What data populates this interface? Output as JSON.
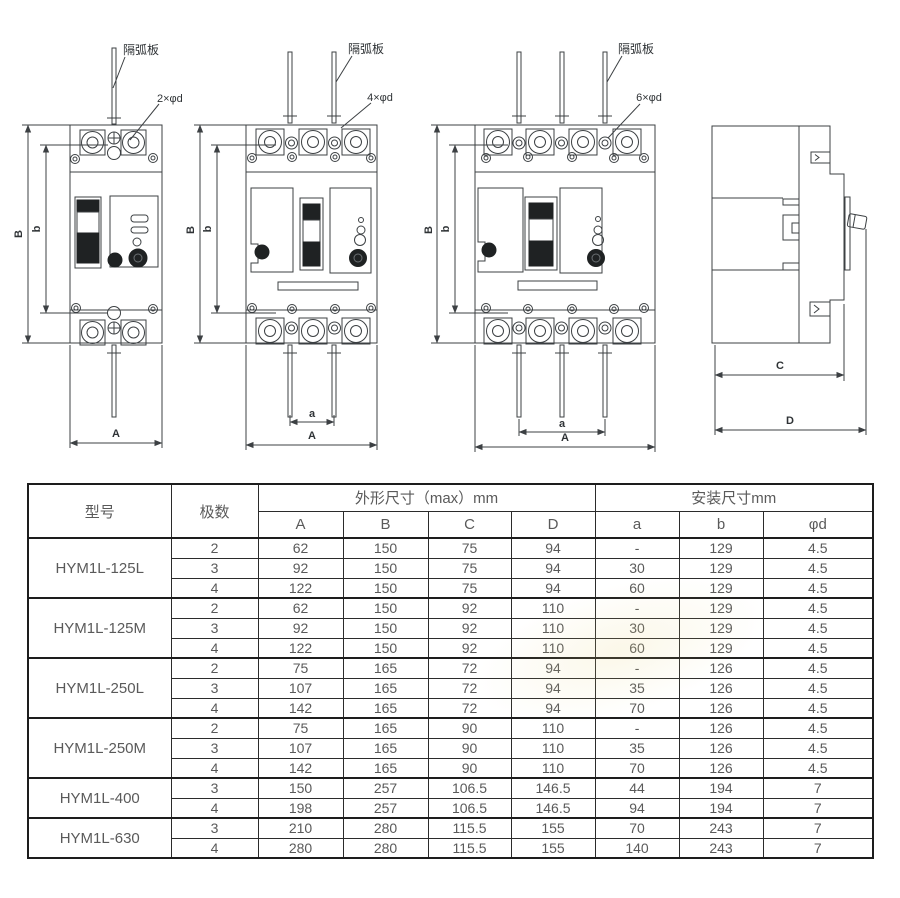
{
  "drawings": {
    "arc_plate_label": "隔弧板",
    "front_views": {
      "two_pole": {
        "holes": "2×φd"
      },
      "three_pole": {
        "holes": "4×φd"
      },
      "four_pole": {
        "holes": "6×φd"
      }
    },
    "dims": {
      "A": "A",
      "B": "B",
      "a": "a",
      "b": "b",
      "C": "C",
      "D": "D"
    },
    "line_color": "#3c4043"
  },
  "table": {
    "header": {
      "model": "型号",
      "poles": "极数",
      "outline_group": "外形尺寸（max）mm",
      "install_group": "安装尺寸mm",
      "outline_cols": [
        "A",
        "B",
        "C",
        "D"
      ],
      "install_cols": [
        "a",
        "b",
        "φd"
      ]
    },
    "groups": [
      {
        "model": "HYM1L-125L",
        "rows": [
          {
            "poles": "2",
            "A": "62",
            "B": "150",
            "C": "75",
            "D": "94",
            "a": "-",
            "b": "129",
            "phid": "4.5"
          },
          {
            "poles": "3",
            "A": "92",
            "B": "150",
            "C": "75",
            "D": "94",
            "a": "30",
            "b": "129",
            "phid": "4.5"
          },
          {
            "poles": "4",
            "A": "122",
            "B": "150",
            "C": "75",
            "D": "94",
            "a": "60",
            "b": "129",
            "phid": "4.5"
          }
        ]
      },
      {
        "model": "HYM1L-125M",
        "rows": [
          {
            "poles": "2",
            "A": "62",
            "B": "150",
            "C": "92",
            "D": "110",
            "a": "-",
            "b": "129",
            "phid": "4.5"
          },
          {
            "poles": "3",
            "A": "92",
            "B": "150",
            "C": "92",
            "D": "110",
            "a": "30",
            "b": "129",
            "phid": "4.5"
          },
          {
            "poles": "4",
            "A": "122",
            "B": "150",
            "C": "92",
            "D": "110",
            "a": "60",
            "b": "129",
            "phid": "4.5"
          }
        ]
      },
      {
        "model": "HYM1L-250L",
        "rows": [
          {
            "poles": "2",
            "A": "75",
            "B": "165",
            "C": "72",
            "D": "94",
            "a": "-",
            "b": "126",
            "phid": "4.5"
          },
          {
            "poles": "3",
            "A": "107",
            "B": "165",
            "C": "72",
            "D": "94",
            "a": "35",
            "b": "126",
            "phid": "4.5"
          },
          {
            "poles": "4",
            "A": "142",
            "B": "165",
            "C": "72",
            "D": "94",
            "a": "70",
            "b": "126",
            "phid": "4.5"
          }
        ]
      },
      {
        "model": "HYM1L-250M",
        "rows": [
          {
            "poles": "2",
            "A": "75",
            "B": "165",
            "C": "90",
            "D": "110",
            "a": "-",
            "b": "126",
            "phid": "4.5"
          },
          {
            "poles": "3",
            "A": "107",
            "B": "165",
            "C": "90",
            "D": "110",
            "a": "35",
            "b": "126",
            "phid": "4.5"
          },
          {
            "poles": "4",
            "A": "142",
            "B": "165",
            "C": "90",
            "D": "110",
            "a": "70",
            "b": "126",
            "phid": "4.5"
          }
        ]
      },
      {
        "model": "HYM1L-400",
        "rows": [
          {
            "poles": "3",
            "A": "150",
            "B": "257",
            "C": "106.5",
            "D": "146.5",
            "a": "44",
            "b": "194",
            "phid": "7"
          },
          {
            "poles": "4",
            "A": "198",
            "B": "257",
            "C": "106.5",
            "D": "146.5",
            "a": "94",
            "b": "194",
            "phid": "7"
          }
        ]
      },
      {
        "model": "HYM1L-630",
        "rows": [
          {
            "poles": "3",
            "A": "210",
            "B": "280",
            "C": "115.5",
            "D": "155",
            "a": "70",
            "b": "243",
            "phid": "7"
          },
          {
            "poles": "4",
            "A": "280",
            "B": "280",
            "C": "115.5",
            "D": "155",
            "a": "140",
            "b": "243",
            "phid": "7"
          }
        ]
      }
    ]
  }
}
